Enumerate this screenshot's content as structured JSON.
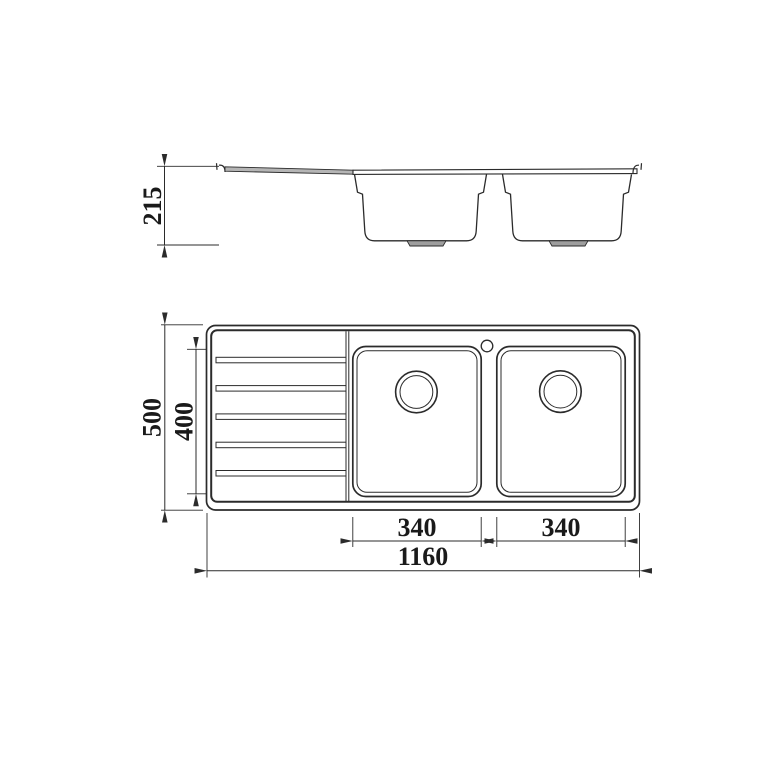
{
  "drawing": {
    "title": "Double-bowl kitchen sink with left drainboard - dimensioned technical drawing",
    "views": {
      "side_view": {
        "name": "side elevation"
      },
      "plan_view": {
        "name": "top plan"
      }
    },
    "dimensions": {
      "side_depth": "215",
      "plan_overall_depth": "500",
      "plan_bowl_depth": "400",
      "plan_bowl1_width": "340",
      "plan_bowl2_width": "340",
      "plan_overall_width": "1160"
    },
    "colors": {
      "line": "#2b2b2b",
      "text": "#1a1a1a",
      "drainboard_shade": "#b5b5b5",
      "drain_shade": "#9e9e9e",
      "background": "#ffffff"
    }
  }
}
